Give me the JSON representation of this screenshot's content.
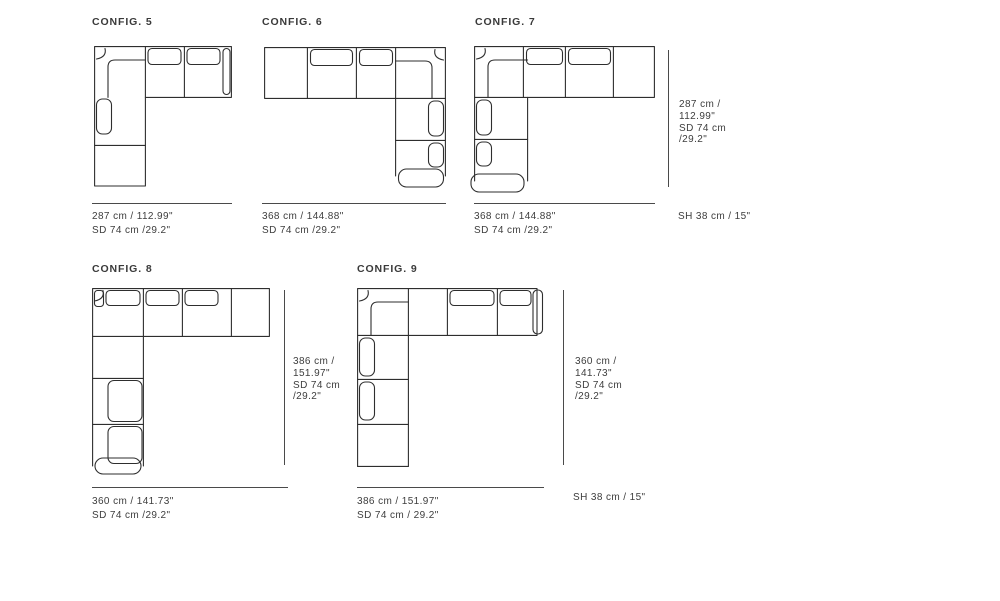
{
  "sheet": {
    "background": "#ffffff",
    "line_color": "#2e2e2e",
    "dimension_line_color": "#4a4a4a",
    "text_color": "#3d3d3d"
  },
  "configs": [
    {
      "title": "CONFIG. 5",
      "width_label": "287 cm / 112.99\"",
      "seat_depth_label": "SD 74 cm /29.2\""
    },
    {
      "title": "CONFIG. 6",
      "width_label": "368 cm / 144.88\"",
      "seat_depth_label": "SD 74 cm /29.2\""
    },
    {
      "title": "CONFIG. 7",
      "width_label": "368 cm / 144.88\"",
      "seat_depth_label": "SD 74 cm /29.2\"",
      "side_label_lines": [
        "287 cm /",
        "112.99\"",
        "SD 74 cm",
        "/29.2\""
      ],
      "seat_height_label": "SH 38 cm / 15\""
    },
    {
      "title": "CONFIG. 8",
      "width_label": "360 cm / 141.73\"",
      "seat_depth_label": "SD 74 cm /29.2\"",
      "side_label_lines": [
        "386 cm /",
        "151.97\"",
        "SD 74 cm",
        "/29.2\""
      ]
    },
    {
      "title": "CONFIG. 9",
      "width_label": "386 cm / 151.97\"",
      "seat_depth_label": "SD 74 cm / 29.2\"",
      "side_label_lines": [
        "360 cm /",
        "141.73\"",
        "SD 74 cm",
        "/29.2\""
      ],
      "seat_height_label": "SH 38 cm / 15\""
    }
  ]
}
